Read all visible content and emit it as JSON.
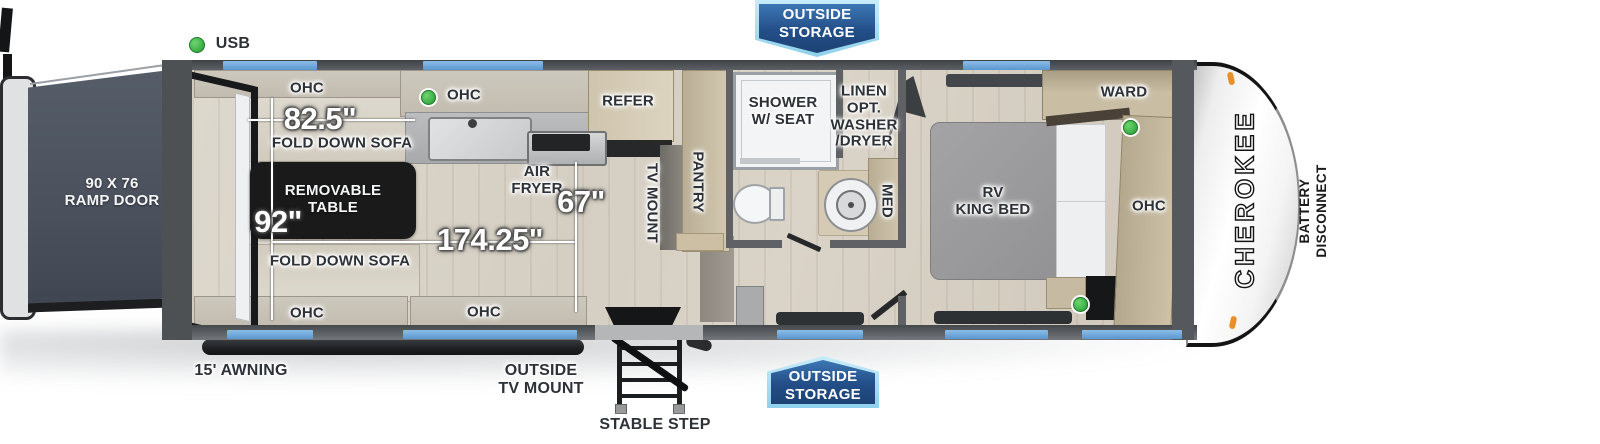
{
  "colors": {
    "badge_blue": "#2a5c9d",
    "badge_border_blue": "#a8ddf4",
    "window_blue": "#6aa5db",
    "usb_green": "#3fb349",
    "wall_gray": "#55585c",
    "floor_tan": "#d8d2c7",
    "table_black": "#1a1a1a",
    "marker_orange": "#e78f28"
  },
  "badges": {
    "top": {
      "line1": "OUTSIDE",
      "line2": "STORAGE"
    },
    "bottom": {
      "line1": "OUTSIDE",
      "line2": "STORAGE"
    }
  },
  "exterior": {
    "usb": "USB",
    "ramp_door": {
      "line1": "90 X 76",
      "line2": "RAMP DOOR"
    },
    "awning": "15' AWNING",
    "outside_tv": {
      "line1": "OUTSIDE",
      "line2": "TV MOUNT"
    },
    "stable_step": "STABLE STEP",
    "battery": {
      "line1": "BATTERY",
      "line2": "DISCONNECT"
    },
    "brand": "CHEROKEE"
  },
  "garage": {
    "ohc_top": "OHC",
    "ohc_kitchen": "OHC",
    "ohc_bottom_left": "OHC",
    "ohc_bottom_right": "OHC",
    "sofa_top": "FOLD DOWN SOFA",
    "sofa_bottom": "FOLD DOWN SOFA",
    "table": {
      "line1": "REMOVABLE",
      "line2": "TABLE"
    },
    "dim_sofa": "82.5\"",
    "dim_width": "92\"",
    "dim_length": "174.25\"",
    "dim_counter": "67\""
  },
  "kitchen": {
    "air_fryer": {
      "line1": "AIR",
      "line2": "FRYER"
    },
    "refer": "REFER",
    "tv_mount": "TV MOUNT",
    "pantry": "PANTRY"
  },
  "bath": {
    "shower": {
      "line1": "SHOWER",
      "line2": "W/ SEAT"
    },
    "linen": {
      "line1": "LINEN",
      "line2": "OPT.",
      "line3": "WASHER",
      "line4": "/DRYER"
    },
    "med": "MED"
  },
  "bedroom": {
    "bed": {
      "line1": "RV",
      "line2": "KING BED"
    },
    "ward": "WARD",
    "ohc": "OHC"
  }
}
